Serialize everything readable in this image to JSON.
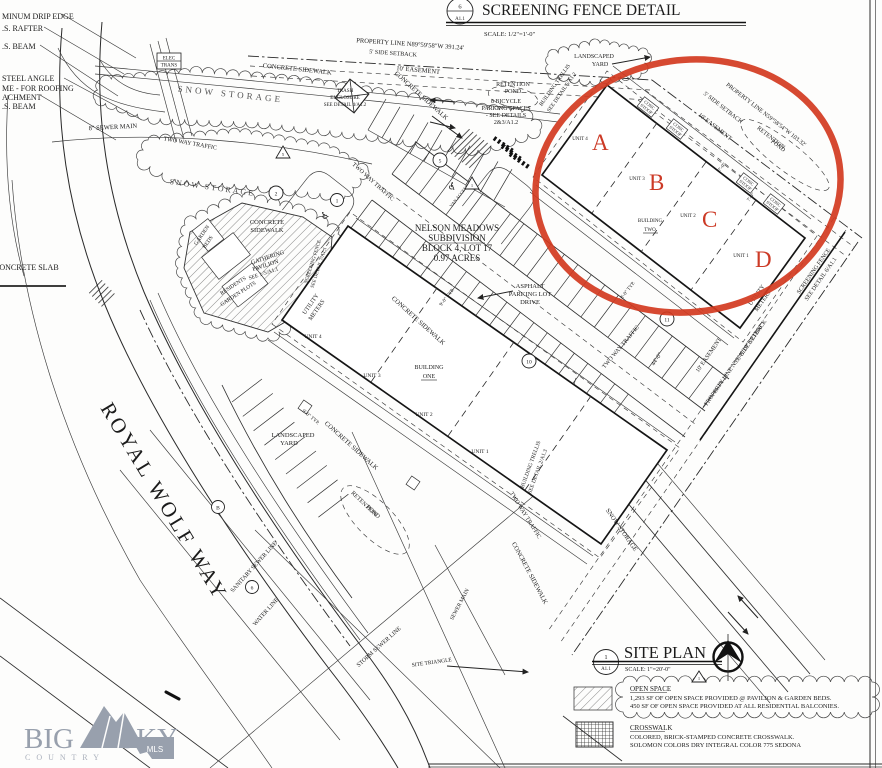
{
  "colors": {
    "ink": "#1b1b1b",
    "highlight_red": "#cc3a26",
    "logo_gray": "#98a0ad"
  },
  "screening_detail": {
    "num": "6",
    "sheet": "A1.1",
    "title": "SCREENING FENCE DETAIL",
    "scale": "SCALE:    1/2\"=1'-0\""
  },
  "site_plan": {
    "num": "1",
    "sheet": "A1.1",
    "title": "SITE PLAN",
    "scale": "SCALE:    1\"=20'-0\""
  },
  "legend": {
    "open_space_title": "OPEN SPACE",
    "open_space_1": "1,293 SF OF OPEN SPACE PROVIDED @ PAVILION & GARDEN BEDS.",
    "open_space_2": "450 SF OF OPEN SPACE PROVIDED AT ALL RESIDENTIAL BALCONIES.",
    "crosswalk_title": "CROSSWALK",
    "crosswalk_1": "COLORED, BRICK-STAMPED CONCRETE CROSSWALK.",
    "crosswalk_2": "SOLOMON COLORS DRY INTEGRAL COLOR 775 SEDONA"
  },
  "logo": {
    "big": "BIG",
    "sky": "SKY",
    "country": "C O U N T R Y",
    "mls": "MLS"
  },
  "street_name": "ROYAL WOLF WAY",
  "parcel": {
    "l1": "NELSON MEADOWS",
    "l2": "SUBDIVISION",
    "l3": "BLOCK 4, LOT 17",
    "l4": "0.97 ACRES"
  },
  "buildings": {
    "name": "BUILDING",
    "one": "ONE",
    "two": "TWO",
    "unit1": "UNIT 1",
    "unit2": "UNIT 2",
    "unit3": "UNIT 3",
    "unit4": "UNIT 4",
    "m_a": "A",
    "m_b": "B",
    "m_c": "C",
    "m_d": "D"
  },
  "notes": {
    "drip_edge": "MINUM DRIP EDGE",
    "rafter": ".S. RAFTER",
    "beam": ".S. BEAM",
    "steel_angle": "STEEL ANGLE",
    "roofing": "ME - FOR ROOFING",
    "attachment": "ACHMENT",
    "beam2": ".S. BEAM",
    "sewer_main_8": "8\" SEWER MAIN",
    "elec": "ELEC",
    "trans": "TRANS",
    "concrete_slab": "CONCRETE SLAB"
  },
  "ann": {
    "prop_line_top": "PROPERTY LINE   N89°59'58\"W   391.24'",
    "prop_line_ne": "PROPERTY LINE   N59°58'54\"W   103.32'",
    "prop_line_se": "PROPERTY LINE   N59°41'19\"E   233.08'",
    "side_setback": "5' SIDE SETBACK",
    "easement_10": "10' EASEMENT",
    "concrete": "CONCRETE",
    "sidewalk": "SIDEWALK",
    "concrete_sidewalk": "CONCRETE SIDEWALK",
    "snow_storage": "SNOW STORAGE",
    "two_way_traffic": "TWO WAY TRAFFIC",
    "trash_1": "TRASH",
    "trash_2": "ENCLOSURE",
    "trash_3": "SEE DETAIL 4/A1.2",
    "bike_1": "8 BICYCLE",
    "bike_2": "PARKING SPACES",
    "bike_3": "- SEE DETAILS",
    "bike_4": "2&3/A1.2",
    "retention": "RETENTION",
    "pond": "POND",
    "asphalt_1": "ASPHALT",
    "asphalt_2": "PARKING LOT",
    "asphalt_3": "DRIVE",
    "landscaped": "LANDSCAPED",
    "yard": "YARD",
    "gathering_1": "GATHERING",
    "gathering_2": "PAVILION",
    "gathering_3": "SEE 1-5/A1.1",
    "residents_1": "RESIDENTS",
    "residents_2": "GARDEN PLOTS",
    "garden_1": "GARDEN",
    "garden_2": "BEDS",
    "screening_7_1": "SCREENING FENCE",
    "screening_7_2": "SEE DETAIL 7/A1.1",
    "screening_6_1": "SCREENING FENCE",
    "screening_6_2": "SEE DETAIL 6/A1.1",
    "trellis": "BUILDING TRELLIS",
    "trellis_5": "SEE DETAIL 5/A1.2",
    "trellis_2": "SEE DETAIL 2/A1.3",
    "utility_1": "UTILITY",
    "utility_2": "METERS",
    "conc": "CONC",
    "stoop": "STOOP",
    "sanitary": "SANITARY SEWER LINE",
    "water": "WATER LINE",
    "storm": "STORM SEWER LINE",
    "sewer_main": "SEWER MAIN",
    "site_triangle": "SITE TRIANGLE",
    "van": "VAN ACCESS",
    "dim_9": "9'-0\" TYP.",
    "dim_7": "7'-0\"",
    "dim_18": "18'-0\" TYP.",
    "dim_44": "44'-0\"",
    "handicap": "♿"
  },
  "bubbles": {
    "n1": "1",
    "n2": "2",
    "n5": "5",
    "n6": "6",
    "n10": "10",
    "n11": "11",
    "nb": "B"
  }
}
